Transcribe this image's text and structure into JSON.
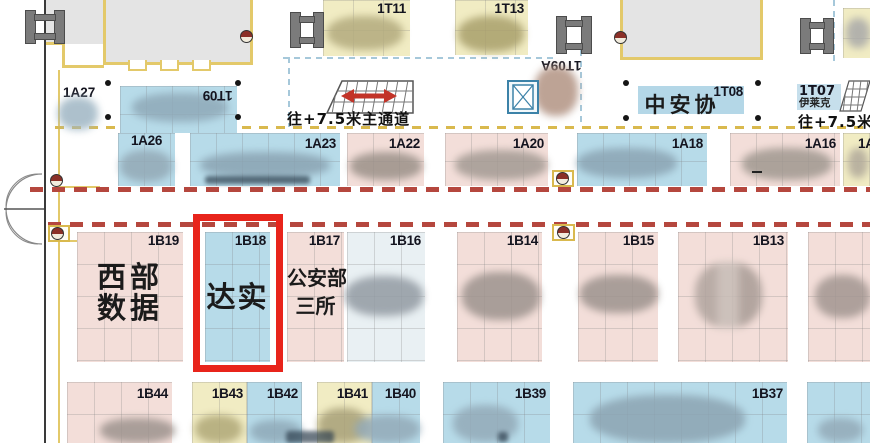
{
  "colors": {
    "booth_pink": "#f3ded9",
    "booth_blue": "#b7dbe9",
    "booth_light_blue": "#e9f0f3",
    "booth_yellow": "#f1ecc3",
    "building_gray": "#e4e4e4",
    "wall_yellow": "#e3c96a",
    "dash_red": "#b5473e",
    "dash_yellow": "#d9b94e",
    "dash_blue": "#a6c8da",
    "highlight_red": "#e8241b"
  },
  "top": {
    "t11": "1T11",
    "t13": "1T13",
    "t09a": "1T09A",
    "t09": "1T09",
    "a27": "1A27",
    "t08_id": "1T08",
    "t08_name": "中安协",
    "t07_id": "1T07",
    "t07_name": "伊莱克",
    "aisle_main": "往+7.5米主通道",
    "aisle_right": "往+7.5米"
  },
  "row_a": {
    "a26": "1A26",
    "a23": "1A23",
    "a22": "1A22",
    "a20": "1A20",
    "a18": "1A18",
    "a16": "1A16",
    "a14": "1A1"
  },
  "row_b": {
    "b19": "1B19",
    "b19_l1": "西部",
    "b19_l2": "数据",
    "b18": "1B18",
    "b18_name": "达实",
    "highlighted": "1B18",
    "b17": "1B17",
    "b17_l1": "公安部",
    "b17_l2": "三所",
    "b16": "1B16",
    "b14": "1B14",
    "b15": "1B15",
    "b13": "1B13"
  },
  "row_c": {
    "b44": "1B44",
    "b43": "1B43",
    "b42": "1B42",
    "b41": "1B41",
    "b40": "1B40",
    "b39": "1B39",
    "b37": "1B37"
  }
}
